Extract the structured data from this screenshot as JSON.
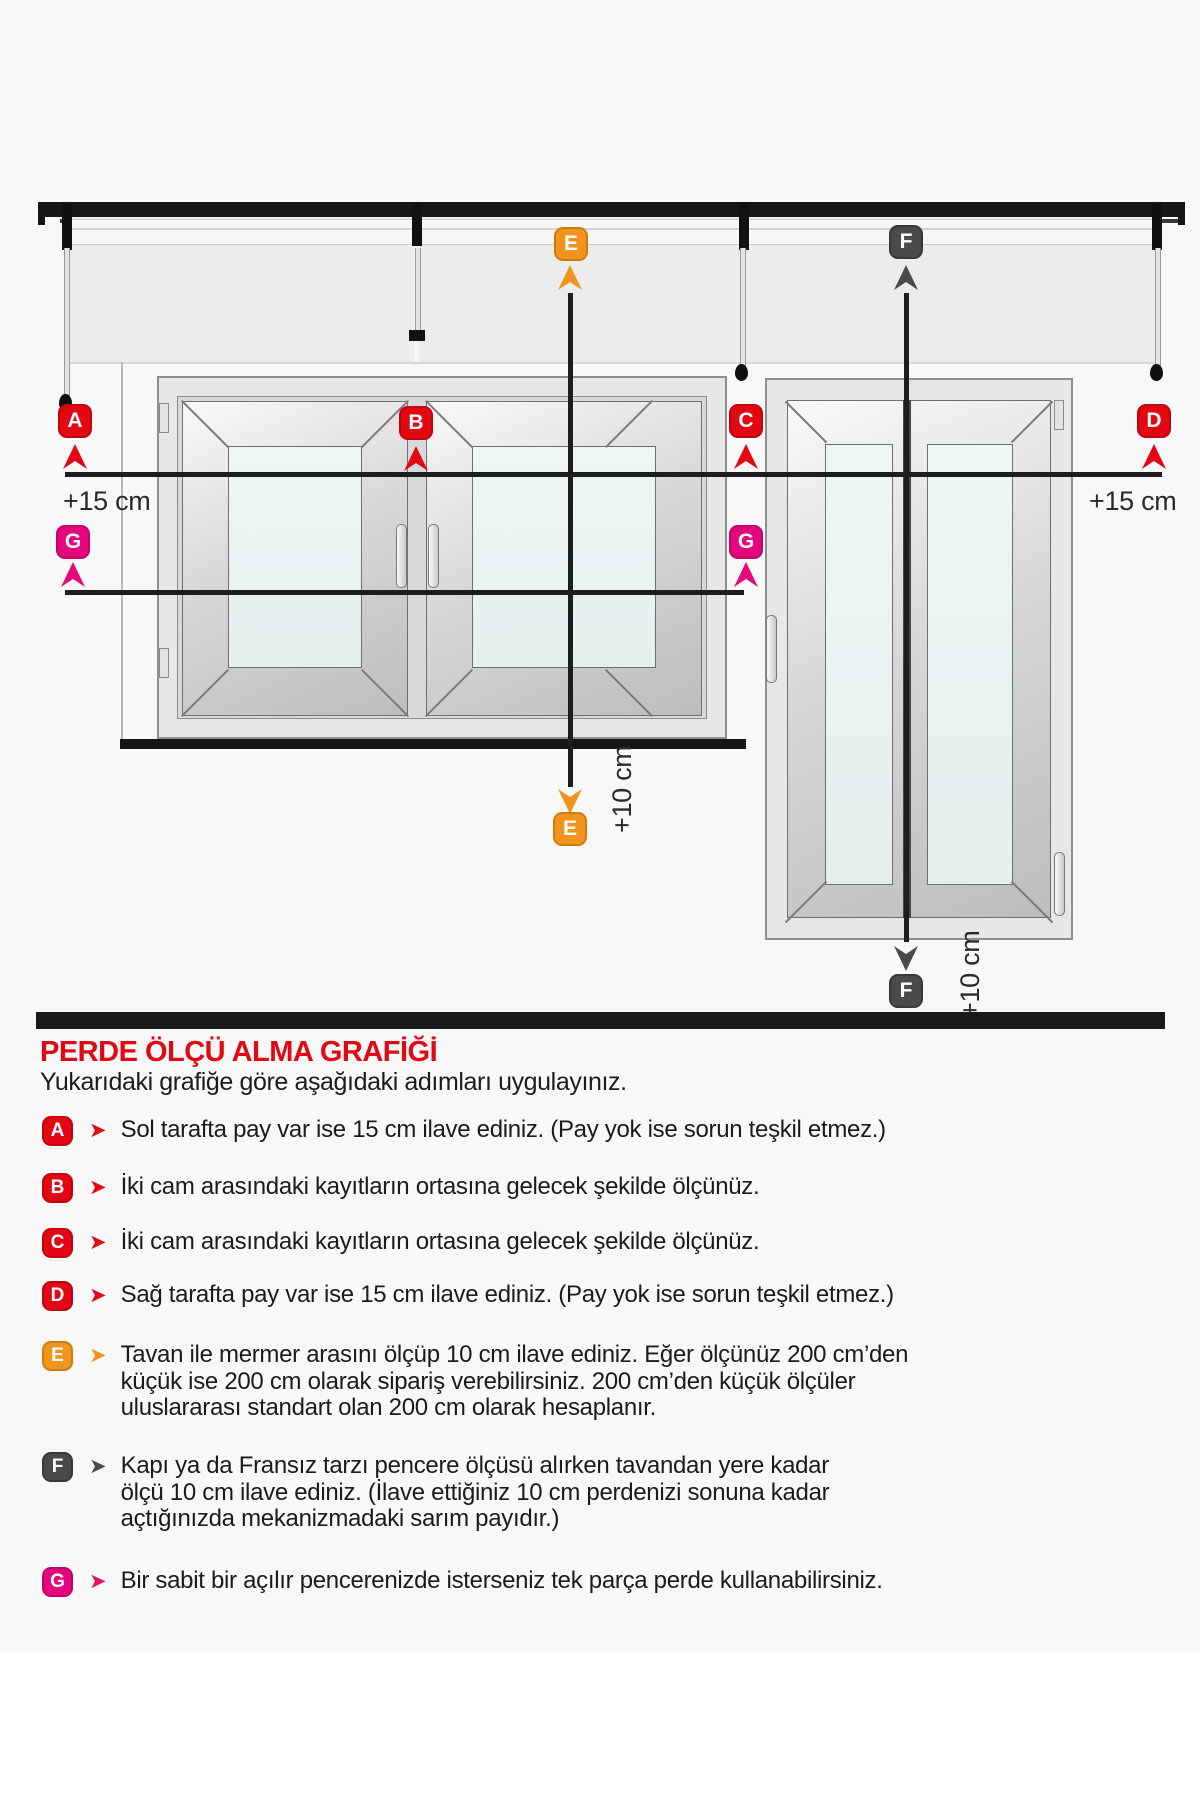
{
  "header": {
    "title": "PERDE ÖLÇÜ ALMA GRAFİĞİ",
    "subtitle": "Yukarıdaki grafiğe göre aşağıdaki adımları uygulayınız."
  },
  "colors": {
    "red": "#e30613",
    "orange": "#f0941e",
    "dark_gray": "#4a4a4a",
    "magenta": "#e5067e",
    "line_black": "#1d1d1d",
    "background": "#f8f8f8"
  },
  "diagram": {
    "markers": {
      "A": "A",
      "B": "B",
      "C": "C",
      "D": "D",
      "E": "E",
      "F": "F",
      "G": "G"
    },
    "plus15_left": "+15 cm",
    "plus15_right": "+15 cm",
    "plus10_e": "+10 cm",
    "plus10_f": "+10 cm"
  },
  "instructions": [
    {
      "letter": "A",
      "color": "red",
      "text": "Sol tarafta pay var ise 15 cm ilave ediniz. (Pay yok ise sorun teşkil etmez.)"
    },
    {
      "letter": "B",
      "color": "red",
      "text": "İki cam arasındaki kayıtların ortasına gelecek şekilde ölçünüz."
    },
    {
      "letter": "C",
      "color": "red",
      "text": "İki cam arasındaki kayıtların ortasına gelecek şekilde ölçünüz."
    },
    {
      "letter": "D",
      "color": "red",
      "text": "Sağ tarafta pay var ise 15 cm ilave ediniz. (Pay yok ise sorun teşkil etmez.)"
    },
    {
      "letter": "E",
      "color": "orange",
      "text": "Tavan ile mermer arasını ölçüp 10 cm ilave ediniz. Eğer ölçünüz 200 cm’den\nküçük ise 200 cm olarak sipariş verebilirsiniz. 200 cm’den küçük ölçüler\nuluslararası standart olan 200 cm olarak hesaplanır."
    },
    {
      "letter": "F",
      "color": "dark",
      "text": "Kapı ya da Fransız tarzı pencere ölçüsü alırken tavandan yere kadar\nölçü 10 cm ilave ediniz. (İlave ettiğiniz 10 cm perdenizi sonuna kadar\naçtığınızda mekanizmadaki sarım payıdır.)"
    },
    {
      "letter": "G",
      "color": "magenta",
      "text": "Bir sabit bir açılır pencerenizde isterseniz tek parça perde kullanabilirsiniz."
    }
  ]
}
